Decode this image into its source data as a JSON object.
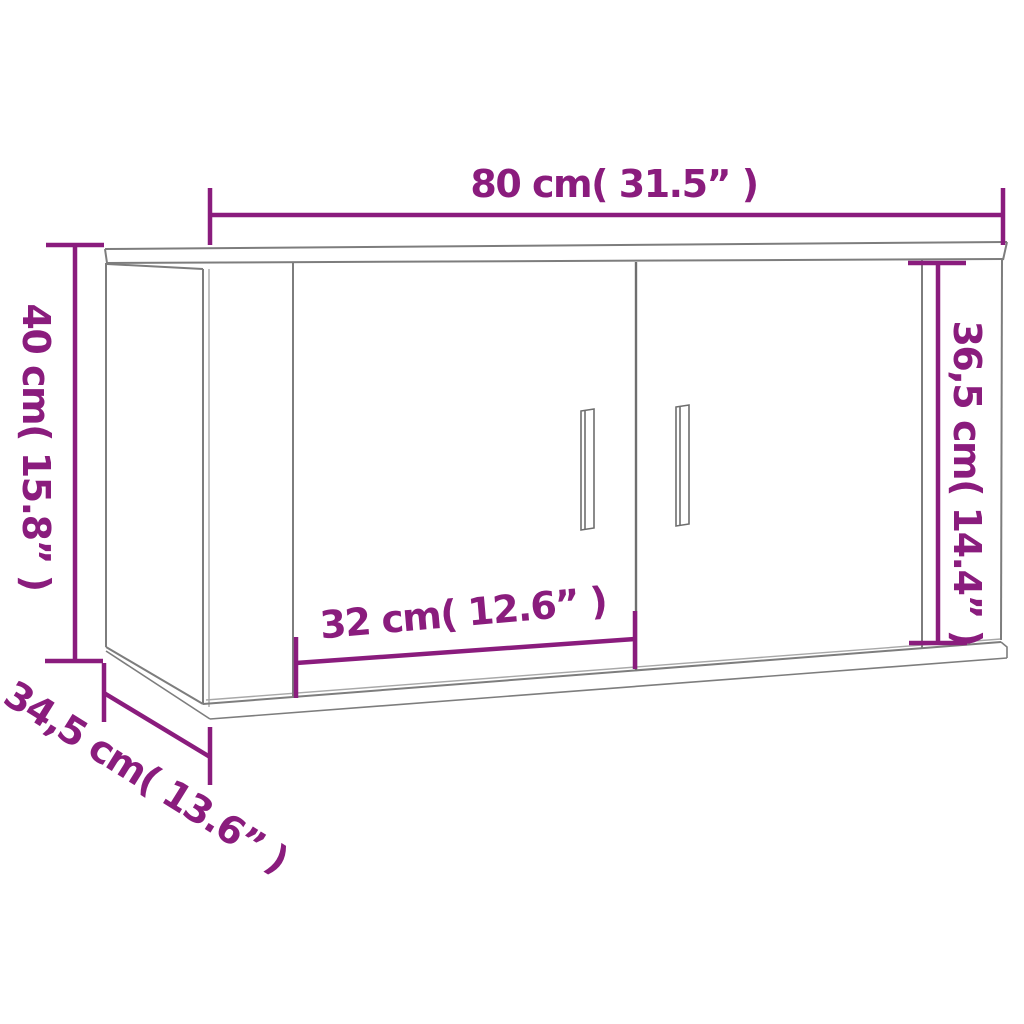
{
  "diagram": {
    "title": "Wall-mounted cabinet dimension diagram",
    "product": "Wall cabinet with two doors",
    "colors": {
      "dimension_accent": "#8a1c7d",
      "outline_gray": "#7d7d7d",
      "outline_light_gray": "#a8a8a8",
      "outline_dark_gray": "#6e6e6e",
      "background": "#ffffff"
    },
    "dimensions": {
      "overall_width": {
        "label": "80 cm( 31.5” )",
        "cm": 80,
        "inches": 31.5
      },
      "overall_height": {
        "label": "40 cm( 15.8” )",
        "cm": 40,
        "inches": 15.8
      },
      "door_panel_height": {
        "label": "36,5 cm( 14.4” )",
        "cm": 36.5,
        "inches": 14.4
      },
      "door_panel_width": {
        "label": "32 cm( 12.6” )",
        "cm": 32,
        "inches": 12.6
      },
      "depth": {
        "label": "34,5 cm( 13.6” )",
        "cm": 34.5,
        "inches": 13.6
      }
    }
  }
}
